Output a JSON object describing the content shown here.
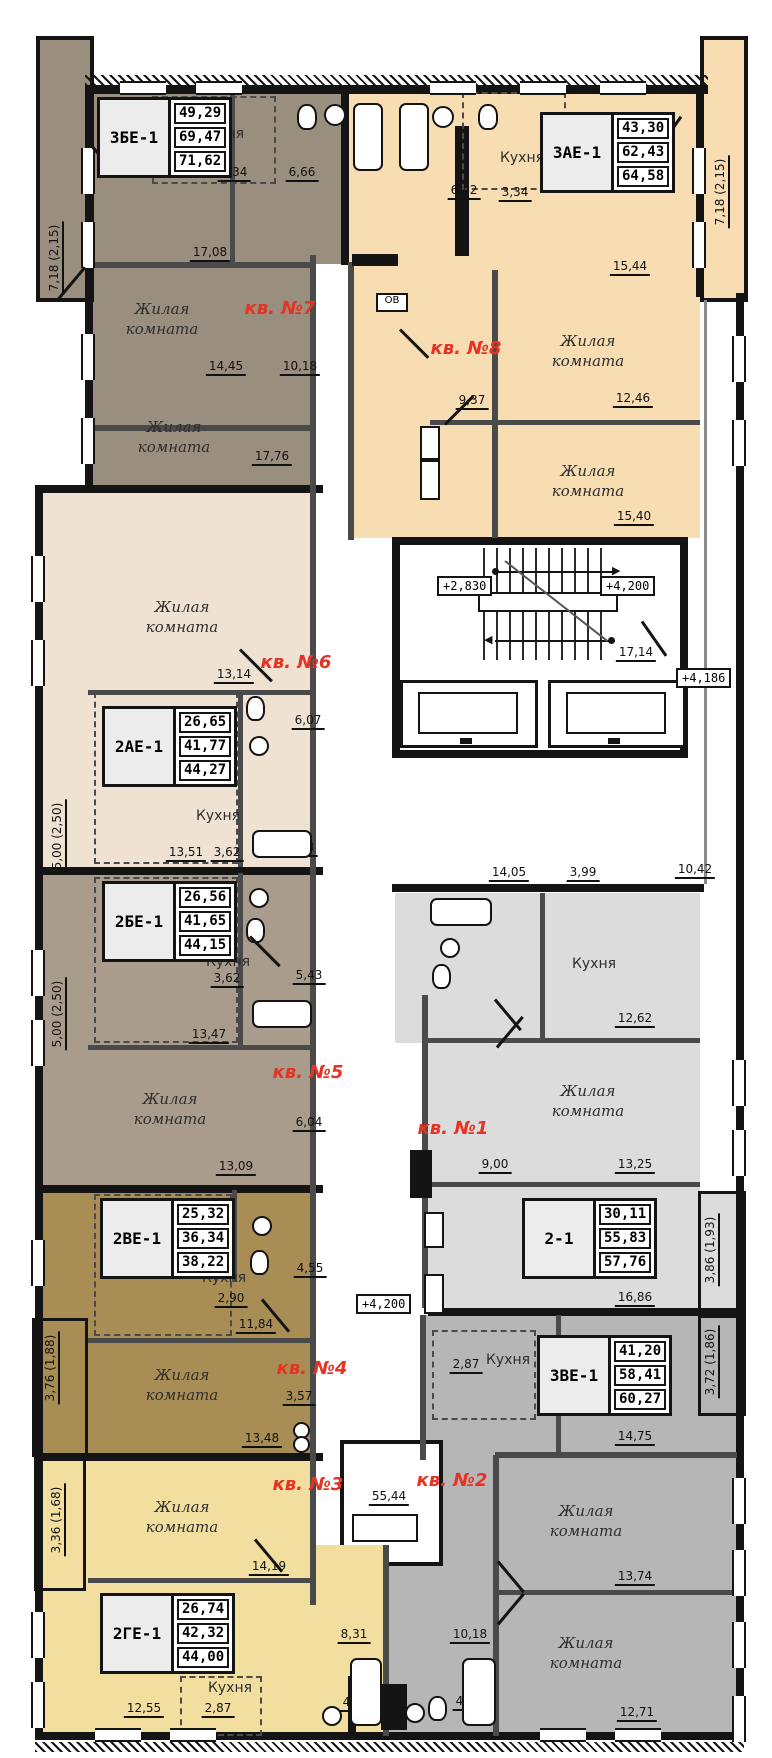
{
  "title": "Поэтажный план",
  "colors": {
    "apt1": "#dcdcdc",
    "apt2": "#b6b6b6",
    "apt3": "#f2dfa0",
    "apt4": "#a88e55",
    "apt5": "#aa9c8c",
    "apt6": "#f0e2d2",
    "apt7": "#9a8e7e",
    "apt8": "#f8ddb2",
    "red": "#e63323",
    "wall": "#141414",
    "partition": "#4a4a4a"
  },
  "labels": {
    "living": "Жилая комната",
    "kitchen": "Кухня"
  },
  "apartments": {
    "a1": {
      "unit": "кв. №1",
      "type": "2-1",
      "areas": [
        "30,11",
        "55,83",
        "57,76"
      ]
    },
    "a2": {
      "unit": "кв. №2",
      "type": "3ВЕ-1",
      "areas": [
        "41,20",
        "58,41",
        "60,27"
      ]
    },
    "a3": {
      "unit": "кв. №3",
      "type": "2ГЕ-1",
      "areas": [
        "26,74",
        "42,32",
        "44,00"
      ]
    },
    "a4": {
      "unit": "кв. №4",
      "type": "2ВЕ-1",
      "areas": [
        "25,32",
        "36,34",
        "38,22"
      ]
    },
    "a5": {
      "unit": "кв. №5",
      "type": "2БЕ-1",
      "areas": [
        "26,56",
        "41,65",
        "44,15"
      ]
    },
    "a6": {
      "unit": "кв. №6",
      "type": "2АЕ-1",
      "areas": [
        "26,65",
        "41,77",
        "44,27"
      ]
    },
    "a7": {
      "unit": "кв. №7",
      "type": "3БЕ-1",
      "areas": [
        "49,29",
        "69,47",
        "71,62"
      ]
    },
    "a8": {
      "unit": "кв. №8",
      "type": "3АЕ-1",
      "areas": [
        "43,30",
        "62,43",
        "64,58"
      ]
    }
  },
  "dims": {
    "a7": [
      "3,34",
      "6,66",
      "17,08",
      "14,45",
      "10,18",
      "17,76"
    ],
    "a8": [
      "6,42",
      "3,34",
      "15,44",
      "12,46",
      "9,37",
      "15,40"
    ],
    "a6": [
      "13,14",
      "6,07",
      "13,51",
      "3,62",
      "5,43"
    ],
    "a5": [
      "3,62",
      "5,43",
      "13,47",
      "6,04",
      "13,09"
    ],
    "a4": [
      "4,55",
      "2,90",
      "11,84",
      "3,57",
      "13,48"
    ],
    "a3": [
      "14,19",
      "12,55",
      "2,87",
      "8,31",
      "4,40"
    ],
    "a1": [
      "14,05",
      "3,99",
      "10,42",
      "12,62",
      "9,00",
      "13,25",
      "16,86"
    ],
    "a2": [
      "2,87",
      "14,75",
      "13,74",
      "12,71",
      "10,18",
      "4,16",
      "55,44"
    ],
    "stair": [
      "17,14"
    ]
  },
  "balconies": {
    "left_top": "7,18 (2,15)",
    "right_top": "7,18 (2,15)",
    "b6": "5,00 (2,50)",
    "b5": "5,00 (2,50)",
    "b4": "3,76 (1,88)",
    "b3": "3,36 (1,68)",
    "b1": "3,86 (1,93)",
    "b2": "3,72 (1,86)"
  },
  "levels": {
    "stair_low": "+2,830",
    "stair_high": "+4,200",
    "corridor": "+4,200",
    "gallery": "+4,186"
  },
  "shafts": {
    "ov": "ОВ",
    "vk": "ВК",
    "pk": "ПК"
  }
}
